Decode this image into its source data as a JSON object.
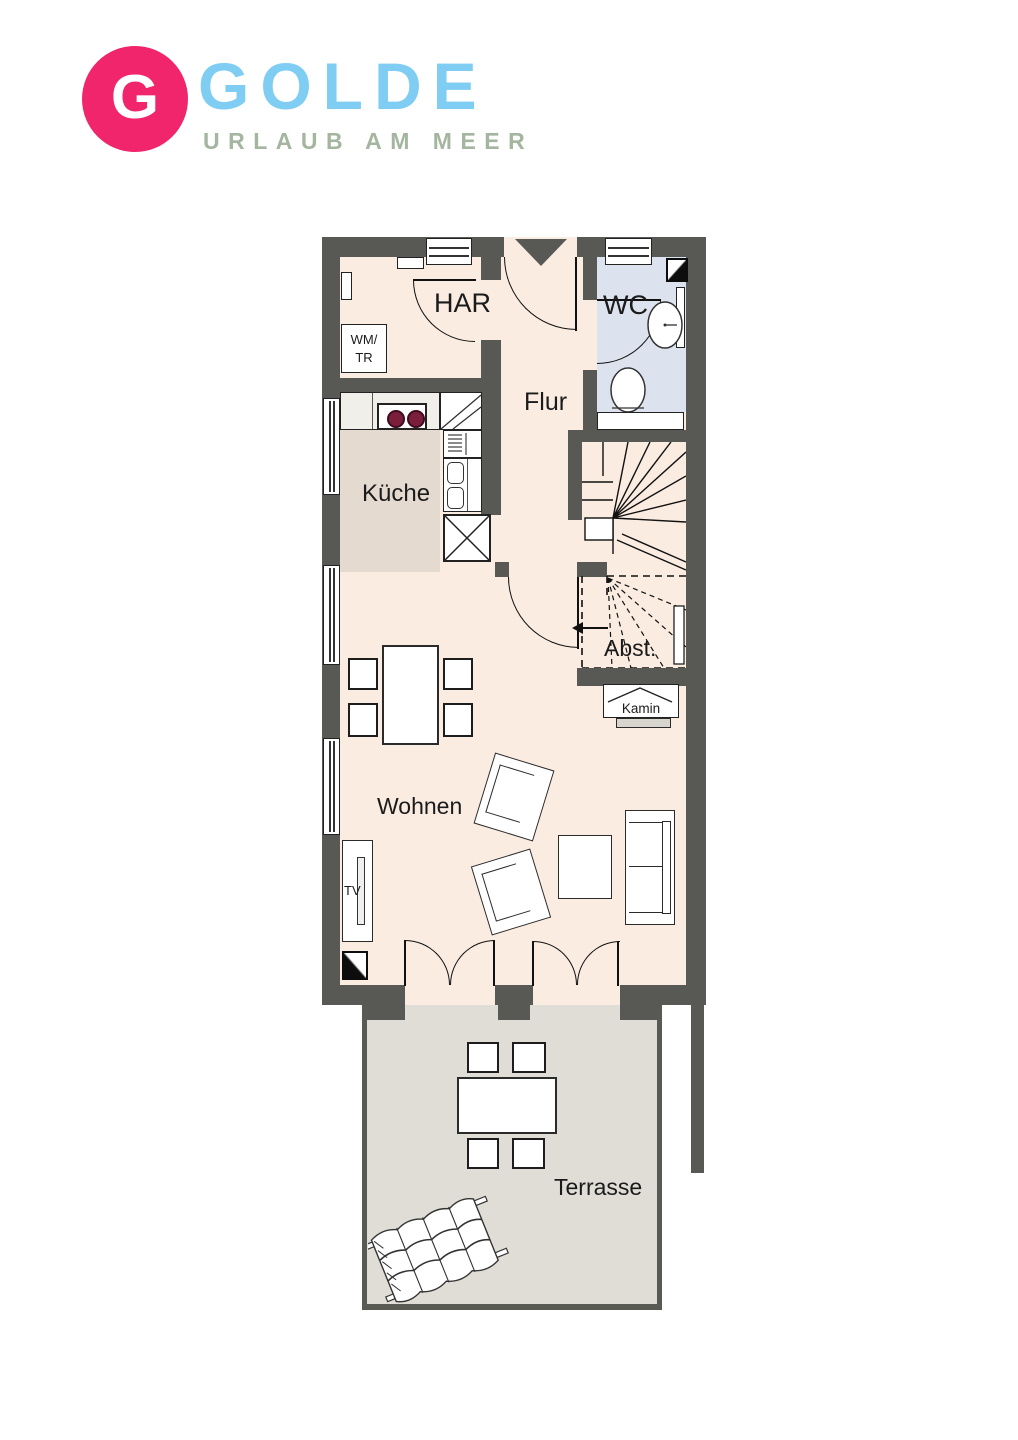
{
  "logo": {
    "monogram": "G",
    "brand": "GOLDE",
    "tagline": "URLAUB AM MEER"
  },
  "colors": {
    "logo_pink": "#f1256b",
    "brand_blue": "#7fcdf2",
    "tagline_green": "#a4b69f",
    "wall_gray": "#585854",
    "floor_peach": "#faece1",
    "kitchen_floor": "#e5dacf",
    "wc_floor": "#dde3ee",
    "terrace_floor": "#dfddd5",
    "burner_red": "#7b1e3c"
  },
  "rooms": {
    "har": "HAR",
    "wc": "WC",
    "flur": "Flur",
    "kueche": "Küche",
    "abstellraum": "Abst.",
    "wohnen": "Wohnen",
    "terrasse": "Terrasse"
  },
  "fixtures": {
    "washer_dryer": "WM/\nTR",
    "tv": "TV",
    "kamin": "Kamin"
  }
}
